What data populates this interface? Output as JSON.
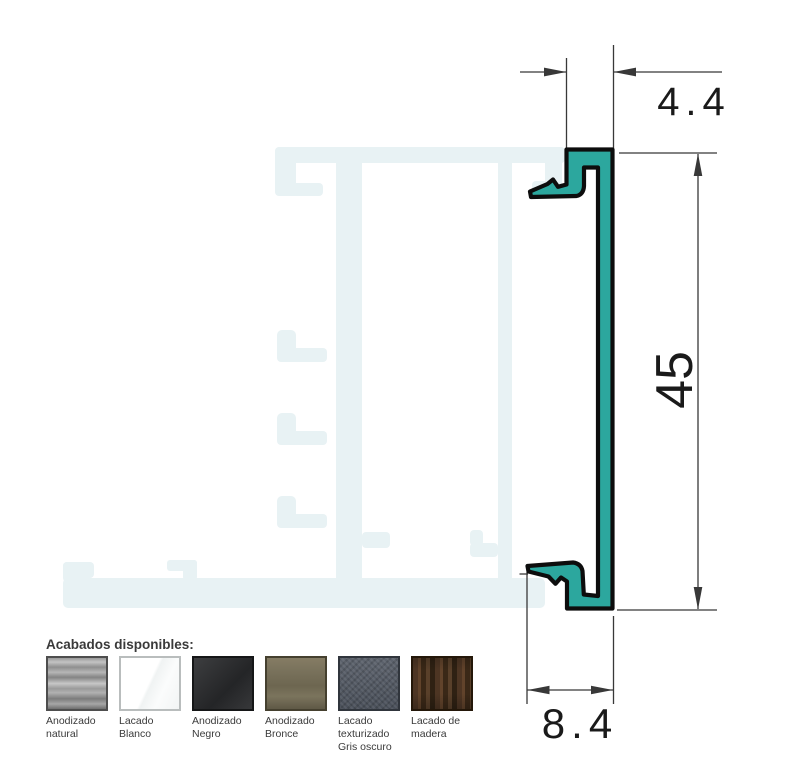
{
  "drawing": {
    "dimensions": {
      "top_width": "4.4",
      "right_height": "45",
      "bottom_width": "8.4"
    },
    "profile_fill": "#2ca79e",
    "outline_color": "#0d0d0d",
    "ghost_fill": "#e8f2f4",
    "dimension_color": "#383838"
  },
  "finishes": {
    "title": "Acabados disponibles:",
    "items": [
      {
        "name": "Anodizado natural"
      },
      {
        "name": "Lacado Blanco"
      },
      {
        "name": "Anodizado Negro"
      },
      {
        "name": "Anodizado Bronce"
      },
      {
        "name": "Lacado texturizado Gris oscuro"
      },
      {
        "name": "Lacado de madera"
      }
    ]
  }
}
